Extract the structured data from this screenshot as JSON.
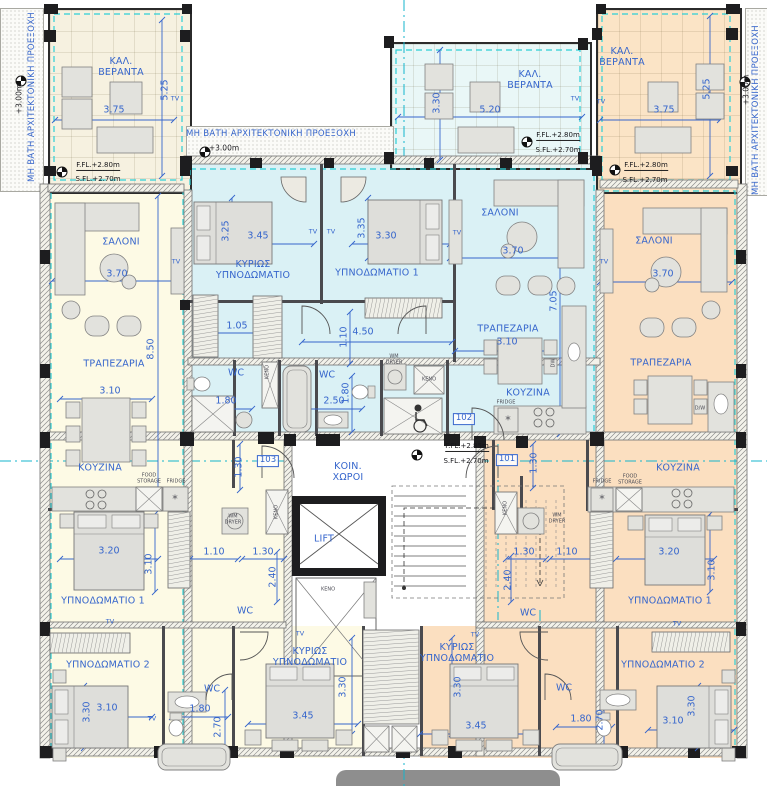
{
  "palette": {
    "accent_blue": "#3565cc",
    "grid_cyan": "#2ccfd6",
    "axis_cyan": "#14b4cc",
    "unit_left_cream": "#fdfae5",
    "unit_center_blue": "#daf1f5",
    "unit_right_peach": "#fbdfc0"
  },
  "labels": [
    [
      "ΜΗ ΒΑΤΗ ΑΡΧΙΤΕΚΤΟΝΙΚΗ ΠΡΟΕΞΟΧΗ",
      33,
      97,
      "annot",
      -90
    ],
    [
      "+3.00m",
      20,
      99,
      "smd",
      -90
    ],
    [
      "ΜΗ ΒΑΤΗ ΑΡΧΙΤΕΚΤΟΝΙΚΗ ΠΡΟΕΞΟΧΗ",
      271,
      135,
      "annot",
      0
    ],
    [
      "+3.00m",
      224,
      149,
      "smd",
      0
    ],
    [
      "ΜΗ ΒΑΤΗ ΑΡΧΙΤΕΚΤΟΝΙΚΗ ΠΡΟΕΞΟΧΗ",
      757,
      110,
      "annot",
      -90
    ],
    [
      "+3.00m",
      747,
      90,
      "smd",
      -90
    ],
    [
      "ΚΑΛ.\nΒΕΡΑΝΤΑ",
      121,
      68,
      "room",
      0
    ],
    [
      "3.75",
      114,
      111,
      "dim",
      0
    ],
    [
      "5.25",
      166,
      90,
      "dim",
      -90
    ],
    [
      "TV",
      175,
      99,
      "tv",
      0
    ],
    [
      "F.FL.+2.80m",
      98,
      166,
      "lvl ul",
      0
    ],
    [
      "S.FL.+2.70m",
      98,
      179,
      "lvl",
      0
    ],
    [
      "ΚΑΛ.\nΒΕΡΑΝΤΑ",
      530,
      81,
      "room",
      0
    ],
    [
      "5.20",
      490,
      111,
      "dim",
      0
    ],
    [
      "3.30",
      438,
      103,
      "dim",
      -90
    ],
    [
      "TV",
      575,
      99,
      "tv",
      0
    ],
    [
      "F.FL.+2.80m",
      558,
      136,
      "lvl ul",
      0
    ],
    [
      "S.FL.+2.70m",
      558,
      150,
      "lvl",
      0
    ],
    [
      "ΚΑΛ.\nΒΕΡΑΝΤΑ",
      622,
      58,
      "room",
      0
    ],
    [
      "3.75",
      664,
      111,
      "dim",
      0
    ],
    [
      "5.25",
      708,
      89,
      "dim",
      -90
    ],
    [
      "TV",
      601,
      102,
      "tv",
      0
    ],
    [
      "F.FL.+2.80m",
      646,
      166,
      "lvl ul",
      0
    ],
    [
      "S.FL.+2.70m",
      645,
      180,
      "lvl",
      0
    ],
    [
      "ΚΥΡΙΩΣ\nΥΠΝΟΔΩΜΑΤΙΟ",
      253,
      271,
      "room",
      0
    ],
    [
      "3.25",
      227,
      231,
      "dim",
      -90
    ],
    [
      "3.45",
      258,
      237,
      "dim",
      0
    ],
    [
      "TV",
      313,
      232,
      "tv",
      0
    ],
    [
      "TV",
      331,
      232,
      "tv",
      0
    ],
    [
      "3.35",
      363,
      228,
      "dim",
      -90
    ],
    [
      "3.30",
      386,
      237,
      "dim",
      0
    ],
    [
      "ΥΠΝΟΔΩΜΑΤΙΟ 1",
      377,
      274,
      "room",
      0
    ],
    [
      "1.05",
      237,
      327,
      "dim",
      0
    ],
    [
      "1.10",
      345,
      337,
      "dim",
      -90
    ],
    [
      "4.50",
      363,
      333,
      "dim",
      0
    ],
    [
      "ΣΑΛΟΝΙ",
      500,
      214,
      "room",
      0
    ],
    [
      "3.70",
      513,
      252,
      "dim",
      0
    ],
    [
      "TV",
      457,
      233,
      "tv",
      0
    ],
    [
      "7.05",
      555,
      301,
      "dim",
      -90
    ],
    [
      "ΤΡΑΠΕΖΑΡΙΑ",
      508,
      330,
      "room",
      0
    ],
    [
      "3.10",
      507,
      343,
      "dim",
      0
    ],
    [
      "ΚΟΥΖΙΝΑ",
      528,
      394,
      "room",
      0
    ],
    [
      "FRIDGE",
      506,
      403,
      "tiny",
      0
    ],
    [
      "DW",
      554,
      363,
      "tiny",
      -90
    ],
    [
      "WC",
      236,
      374,
      "wc",
      0
    ],
    [
      "1.80",
      226,
      402,
      "dim",
      0
    ],
    [
      "ΚΕΝΟ",
      268,
      372,
      "tiny",
      -90
    ],
    [
      "WC",
      327,
      376,
      "wc",
      0
    ],
    [
      "2.50",
      334,
      402,
      "dim",
      0
    ],
    [
      "1.80",
      347,
      393,
      "dim",
      -90
    ],
    [
      "WM\nDRYER",
      394,
      360,
      "tiny",
      0
    ],
    [
      "ΚΕΝΟ",
      429,
      380,
      "tiny",
      0
    ],
    [
      "102",
      464,
      419,
      "tag",
      0
    ],
    [
      "F.FL.+2.85m",
      467,
      447,
      "lvl ul",
      0
    ],
    [
      "S.FL.+2.70m",
      466,
      461,
      "lvl",
      0
    ],
    [
      "ΚΟΙΝ.\nΧΩΡΟΙ",
      348,
      473,
      "room",
      0
    ],
    [
      "LIFT",
      324,
      540,
      "room",
      0
    ],
    [
      "ΚΕΝΟ",
      328,
      590,
      "tiny",
      0
    ],
    [
      "101",
      507,
      460,
      "tag",
      0
    ],
    [
      "103",
      268,
      461,
      "tag",
      0
    ],
    [
      "ΣΑΛΟΝΙ",
      121,
      243,
      "room",
      0
    ],
    [
      "3.70",
      117,
      275,
      "dim",
      0
    ],
    [
      "TV",
      176,
      262,
      "tv",
      0
    ],
    [
      "8.50",
      152,
      349,
      "dim",
      -90
    ],
    [
      "ΤΡΑΠΕΖΑΡΙΑ",
      114,
      365,
      "room",
      0
    ],
    [
      "3.10",
      110,
      392,
      "dim",
      0
    ],
    [
      "ΚΟΥΖΙΝΑ",
      100,
      469,
      "room",
      0
    ],
    [
      "FOOD\nSTORAGE",
      149,
      479,
      "tiny",
      0
    ],
    [
      "FRIDGE",
      176,
      482,
      "tiny",
      0
    ],
    [
      "1.30",
      240,
      467,
      "dim",
      -90
    ],
    [
      "WM\nDRYER",
      233,
      520,
      "tiny",
      0
    ],
    [
      "ΚΕΝΟ",
      277,
      512,
      "tiny",
      -90
    ],
    [
      "3.20",
      109,
      552,
      "dim",
      0
    ],
    [
      "3.10",
      150,
      564,
      "dim",
      -90
    ],
    [
      "1.10",
      214,
      553,
      "dim",
      0
    ],
    [
      "1.30",
      263,
      553,
      "dim",
      0
    ],
    [
      "2.40",
      274,
      577,
      "dim",
      -90
    ],
    [
      "ΥΠΝΟΔΩΜΑΤΙΟ 1",
      103,
      602,
      "room",
      0
    ],
    [
      "TV",
      110,
      622,
      "tv",
      0
    ],
    [
      "WC",
      245,
      612,
      "wc",
      0
    ],
    [
      "ΥΠΝΟΔΩΜΑΤΙΟ 2",
      108,
      666,
      "room",
      0
    ],
    [
      "3.30",
      88,
      712,
      "dim",
      -90
    ],
    [
      "3.10",
      107,
      709,
      "dim",
      0
    ],
    [
      "TV",
      152,
      719,
      "tv",
      0
    ],
    [
      "WC",
      212,
      690,
      "wc",
      0
    ],
    [
      "1.80",
      200,
      710,
      "dim",
      0
    ],
    [
      "2.70",
      219,
      727,
      "dim",
      -90
    ],
    [
      "ΚΥΡΙΩΣ\nΥΠΝΟΔΩΜΑΤΙΟ",
      310,
      658,
      "room",
      0
    ],
    [
      "3.45",
      303,
      717,
      "dim",
      0
    ],
    [
      "3.30",
      344,
      687,
      "dim",
      -90
    ],
    [
      "TV",
      300,
      634,
      "tv",
      0
    ],
    [
      "ΚΥΡΙΩΣ\nΥΠΝΟΔΩΜΑΤΙΟ",
      457,
      654,
      "room",
      0
    ],
    [
      "3.45",
      476,
      727,
      "dim",
      0
    ],
    [
      "3.30",
      459,
      687,
      "dim",
      -90
    ],
    [
      "TV",
      475,
      635,
      "tv",
      0
    ],
    [
      "ΣΑΛΟΝΙ",
      654,
      242,
      "room",
      0
    ],
    [
      "3.70",
      663,
      275,
      "dim",
      0
    ],
    [
      "TV",
      604,
      262,
      "tv",
      0
    ],
    [
      "ΤΡΑΠΕΖΑΡΙΑ",
      661,
      364,
      "room",
      0
    ],
    [
      "D/W",
      700,
      409,
      "tiny",
      0
    ],
    [
      "ΚΟΥΖΙΝΑ",
      678,
      469,
      "room",
      0
    ],
    [
      "FOOD\nSTORAGE",
      630,
      480,
      "tiny",
      0
    ],
    [
      "FRIDGE",
      602,
      482,
      "tiny",
      0
    ],
    [
      "1.30",
      524,
      553,
      "dim",
      0
    ],
    [
      "1.10",
      567,
      553,
      "dim",
      0
    ],
    [
      "3.20",
      669,
      553,
      "dim",
      0
    ],
    [
      "3.10",
      713,
      570,
      "dim",
      -90
    ],
    [
      "ΥΠΝΟΔΩΜΑΤΙΟ 1",
      670,
      602,
      "room",
      0
    ],
    [
      "2.40",
      509,
      580,
      "dim",
      -90
    ],
    [
      "ΚΕΝΟ",
      506,
      508,
      "tiny",
      -90
    ],
    [
      "WM\nDRYER",
      557,
      519,
      "tiny",
      0
    ],
    [
      "WC",
      528,
      614,
      "wc",
      0
    ],
    [
      "1.30",
      535,
      463,
      "dim",
      -90
    ],
    [
      "ΥΠΝΟΔΩΜΑΤΙΟ 2",
      663,
      666,
      "room",
      0
    ],
    [
      "3.10",
      673,
      722,
      "dim",
      0
    ],
    [
      "3.30",
      693,
      706,
      "dim",
      -90
    ],
    [
      "TV",
      677,
      624,
      "tv",
      0
    ],
    [
      "WC",
      564,
      689,
      "wc",
      0
    ],
    [
      "1.80",
      581,
      720,
      "dim",
      0
    ],
    [
      "2.70",
      601,
      720,
      "dim",
      -90
    ],
    [
      "*",
      175,
      500,
      "star",
      0
    ],
    [
      "*",
      508,
      421,
      "star",
      0
    ],
    [
      "*",
      602,
      500,
      "star",
      0
    ]
  ],
  "dim_lines": [
    [
      55,
      120,
      174,
      120
    ],
    [
      162,
      20,
      162,
      176
    ],
    [
      398,
      117,
      582,
      117
    ],
    [
      440,
      50,
      440,
      160
    ],
    [
      600,
      120,
      720,
      120
    ],
    [
      710,
      16,
      710,
      176
    ],
    [
      52,
      281,
      180,
      281
    ],
    [
      158,
      196,
      158,
      500
    ],
    [
      60,
      399,
      152,
      399
    ],
    [
      198,
      244,
      314,
      244
    ],
    [
      232,
      198,
      232,
      258
    ],
    [
      352,
      244,
      450,
      244
    ],
    [
      368,
      198,
      368,
      258
    ],
    [
      302,
      342,
      452,
      342
    ],
    [
      210,
      333,
      262,
      333
    ],
    [
      350,
      312,
      350,
      364
    ],
    [
      450,
      258,
      580,
      258
    ],
    [
      560,
      196,
      560,
      434
    ],
    [
      455,
      351,
      548,
      351
    ],
    [
      600,
      282,
      732,
      282
    ],
    [
      196,
      409,
      252,
      409
    ],
    [
      286,
      409,
      362,
      409
    ],
    [
      352,
      376,
      352,
      432
    ],
    [
      60,
      559,
      158,
      559
    ],
    [
      155,
      514,
      155,
      592
    ],
    [
      190,
      559,
      238,
      559
    ],
    [
      242,
      559,
      284,
      559
    ],
    [
      506,
      559,
      546,
      559
    ],
    [
      550,
      559,
      594,
      559
    ],
    [
      616,
      559,
      714,
      559
    ],
    [
      710,
      514,
      710,
      592
    ],
    [
      62,
      717,
      152,
      717
    ],
    [
      84,
      686,
      84,
      748
    ],
    [
      172,
      717,
      228,
      717
    ],
    [
      225,
      690,
      225,
      756
    ],
    [
      248,
      724,
      358,
      724
    ],
    [
      352,
      638,
      352,
      734
    ],
    [
      420,
      734,
      532,
      734
    ],
    [
      452,
      638,
      452,
      734
    ],
    [
      648,
      730,
      734,
      730
    ],
    [
      698,
      686,
      698,
      748
    ],
    [
      556,
      727,
      612,
      727
    ],
    [
      604,
      694,
      604,
      758
    ],
    [
      240,
      444,
      240,
      490
    ],
    [
      277,
      552,
      277,
      602
    ],
    [
      533,
      444,
      533,
      488
    ],
    [
      511,
      556,
      511,
      602
    ]
  ]
}
